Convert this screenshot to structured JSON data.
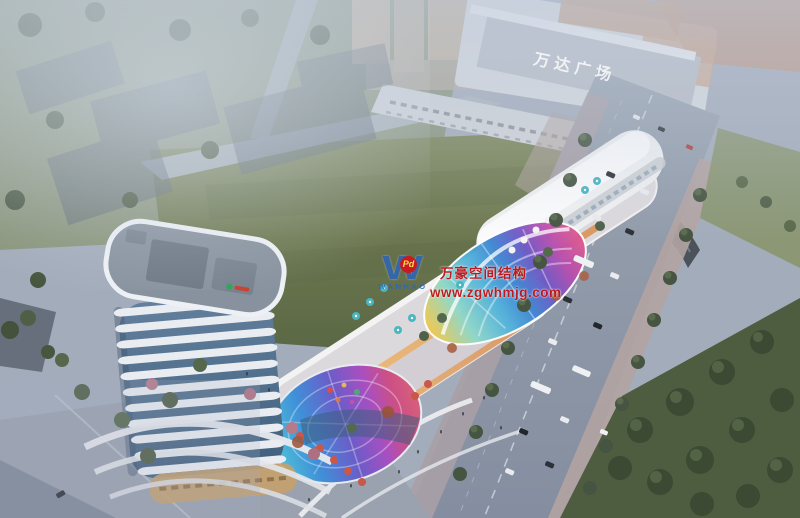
{
  "mall": {
    "sign_text": "万达广场"
  },
  "watermark": {
    "logo_letter": "W",
    "logo_badge": "Pd",
    "brand": "WANHAO",
    "line1": "万豪空间结构",
    "line2": "www.zgwhmjg.com"
  },
  "palette": {
    "watermark_red": "#c01418",
    "watermark_blue": "#2e66b8",
    "field_green": "#6e7a4f",
    "park_green": "#4b5a3e",
    "road_gray": "#8e99a7",
    "tower_white": "#e9edf2",
    "tower_glass": "#516d8b",
    "canopy_colors": [
      "#f2c84e",
      "#8fd8c8",
      "#52b2dc",
      "#3f86d2",
      "#7059c6",
      "#bb4fae",
      "#df5a8c"
    ]
  }
}
